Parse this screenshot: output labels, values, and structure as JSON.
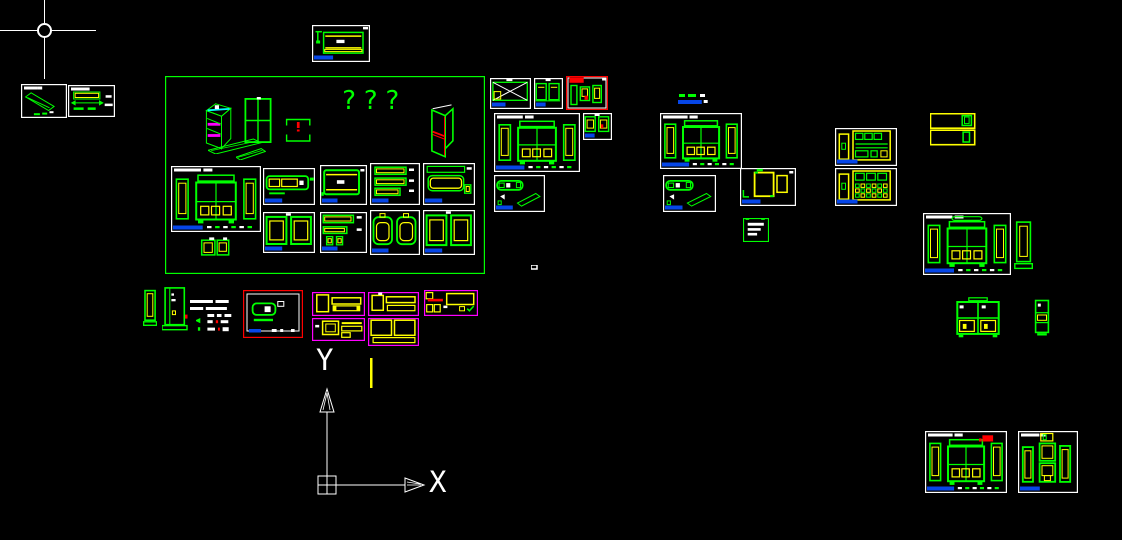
{
  "app": {
    "view": "cad-model-space",
    "background": "#000000"
  },
  "palette": {
    "green": "#00ff00",
    "yellow": "#ffff00",
    "red": "#ff0000",
    "magenta": "#ff00ff",
    "cyan": "#00ffff",
    "blue": "#0646e8",
    "white": "#ffffff",
    "background": "#000000"
  },
  "cursor": {
    "x": 44,
    "y": 30,
    "h_len": 96,
    "v_len": 79
  },
  "ucs_icon": {
    "x_label": "X",
    "y_label": "Y"
  },
  "texts": {
    "question_marks": "???"
  },
  "items": [
    {
      "id": "sheet-iso-plank",
      "kind": "iso_plank",
      "x": 21,
      "y": 84,
      "w": 46,
      "h": 34,
      "border": "white",
      "tt": true
    },
    {
      "id": "sheet-bar-section",
      "kind": "bar_section",
      "x": 68,
      "y": 85,
      "w": 47,
      "h": 32,
      "border": "white",
      "tt": true
    },
    {
      "id": "sheet-top-center",
      "kind": "sheet_cabinet",
      "x": 312,
      "y": 25,
      "w": 58,
      "h": 37,
      "border": "white",
      "tb": true
    },
    {
      "id": "green-boundary-rect",
      "kind": "empty",
      "x": 165,
      "y": 76,
      "w": 320,
      "h": 198,
      "border": "green"
    },
    {
      "id": "iso-cabinet-drawing",
      "kind": "iso_cabinet",
      "x": 198,
      "y": 96,
      "w": 42,
      "h": 56
    },
    {
      "id": "plank-strip-1",
      "kind": "strip",
      "x": 208,
      "y": 137,
      "w": 54,
      "h": 17
    },
    {
      "id": "plank-strip-2",
      "kind": "strip",
      "x": 236,
      "y": 147,
      "w": 30,
      "h": 13
    },
    {
      "id": "four-pane-panel",
      "kind": "panes4",
      "x": 243,
      "y": 97,
      "w": 30,
      "h": 48
    },
    {
      "id": "bracket-detail",
      "kind": "brackets_excl",
      "x": 285,
      "y": 118,
      "w": 27,
      "h": 25
    },
    {
      "id": "iso-door-drawing",
      "kind": "iso_door",
      "x": 427,
      "y": 102,
      "w": 35,
      "h": 57
    },
    {
      "id": "sheet-wardrobe-elev-1",
      "kind": "cab_flanked",
      "x": 171,
      "y": 166,
      "w": 90,
      "h": 66,
      "border": "white",
      "tb": true,
      "tt": true,
      "dash": true
    },
    {
      "id": "mini-cabinet-detail",
      "kind": "mini_cab",
      "x": 200,
      "y": 237,
      "w": 33,
      "h": 21
    },
    {
      "id": "sheet-long-front",
      "kind": "long_front",
      "x": 263,
      "y": 168,
      "w": 52,
      "h": 37,
      "border": "white",
      "tb": true
    },
    {
      "id": "sheet-two-frames-1",
      "kind": "two_frames",
      "x": 263,
      "y": 212,
      "w": 52,
      "h": 41,
      "border": "white",
      "tb": true
    },
    {
      "id": "sheet-board",
      "kind": "board_rect",
      "x": 320,
      "y": 165,
      "w": 47,
      "h": 40,
      "border": "white",
      "tb": true
    },
    {
      "id": "sheet-bars",
      "kind": "bars3",
      "x": 370,
      "y": 163,
      "w": 50,
      "h": 42,
      "border": "white",
      "tb": true
    },
    {
      "id": "sheet-rounded-top",
      "kind": "rect_round",
      "x": 423,
      "y": 163,
      "w": 52,
      "h": 42,
      "border": "white",
      "tb": true
    },
    {
      "id": "sheet-bars-cups",
      "kind": "bars_cups",
      "x": 320,
      "y": 212,
      "w": 47,
      "h": 41,
      "border": "white",
      "tb": true
    },
    {
      "id": "sheet-rounded-pair",
      "kind": "rounded_pair",
      "x": 370,
      "y": 210,
      "w": 50,
      "h": 45,
      "border": "white",
      "tb": true
    },
    {
      "id": "sheet-two-frames-2",
      "kind": "two_frames",
      "x": 423,
      "y": 210,
      "w": 52,
      "h": 45,
      "border": "white",
      "tb": true
    },
    {
      "id": "sheet-crossed-box",
      "kind": "crossed_box",
      "x": 490,
      "y": 78,
      "w": 41,
      "h": 31,
      "border": "white",
      "tb": true
    },
    {
      "id": "sheet-mini-cabs",
      "kind": "mini_cab2",
      "x": 534,
      "y": 78,
      "w": 29,
      "h": 31,
      "border": "white",
      "tb": true
    },
    {
      "id": "sheet-red-flag",
      "kind": "red_flag_cab",
      "x": 566,
      "y": 76,
      "w": 42,
      "h": 34,
      "border": "red"
    },
    {
      "id": "sheet-wardrobe-elev-2",
      "kind": "cab_flanked",
      "x": 494,
      "y": 113,
      "w": 86,
      "h": 59,
      "border": "white",
      "tb": true,
      "tt": true,
      "dash": true
    },
    {
      "id": "sheet-mini-frames",
      "kind": "mini_frames",
      "x": 583,
      "y": 113,
      "w": 29,
      "h": 27,
      "border": "white",
      "tb": true
    },
    {
      "id": "sheet-hardware-1",
      "kind": "iso_bar_plank",
      "x": 494,
      "y": 175,
      "w": 51,
      "h": 37,
      "border": "white",
      "tb": true
    },
    {
      "id": "stray-speck",
      "kind": "speck",
      "x": 531,
      "y": 265,
      "w": 7,
      "h": 5
    },
    {
      "id": "mini-title-block",
      "kind": "mini_title",
      "x": 678,
      "y": 94,
      "w": 33,
      "h": 10
    },
    {
      "id": "sheet-wardrobe-elev-3",
      "kind": "cab_flanked",
      "x": 660,
      "y": 113,
      "w": 82,
      "h": 56,
      "border": "white",
      "tb": true,
      "tt": true,
      "dash": true
    },
    {
      "id": "sheet-hardware-2",
      "kind": "iso_bar_plank",
      "x": 663,
      "y": 175,
      "w": 53,
      "h": 37,
      "border": "white",
      "tb": true
    },
    {
      "id": "sheet-plan-view",
      "kind": "plan_boxes",
      "x": 740,
      "y": 168,
      "w": 56,
      "h": 38,
      "border": "white",
      "tb": true
    },
    {
      "id": "stamp-block",
      "kind": "stamp",
      "x": 743,
      "y": 218,
      "w": 26,
      "h": 24
    },
    {
      "id": "sheet-yellow-cab-1",
      "kind": "yellow_cabinet",
      "x": 835,
      "y": 128,
      "w": 62,
      "h": 38,
      "border": "white",
      "tb": true
    },
    {
      "id": "sheet-yellow-cab-2",
      "kind": "yellow_cabinet_grid",
      "x": 835,
      "y": 168,
      "w": 62,
      "h": 38,
      "border": "white",
      "tb": true
    },
    {
      "id": "yellow-boxes",
      "kind": "yellow_boxes2",
      "x": 930,
      "y": 113,
      "w": 46,
      "h": 33
    },
    {
      "id": "sheet-wardrobe-elev-4",
      "kind": "cab_flanked",
      "x": 923,
      "y": 213,
      "w": 88,
      "h": 62,
      "border": "white",
      "tb": true,
      "tt": true,
      "dash": true,
      "cap": true
    },
    {
      "id": "tower-detail-1",
      "kind": "tower",
      "x": 1014,
      "y": 220,
      "w": 19,
      "h": 52
    },
    {
      "id": "green-cabinet-front",
      "kind": "green_cab_front",
      "x": 955,
      "y": 297,
      "w": 46,
      "h": 42
    },
    {
      "id": "green-cabinet-narrow",
      "kind": "green_cab_narrow",
      "x": 1034,
      "y": 299,
      "w": 16,
      "h": 38
    },
    {
      "id": "tower-detail-2",
      "kind": "tower",
      "x": 143,
      "y": 289,
      "w": 14,
      "h": 39
    },
    {
      "id": "door-elevation",
      "kind": "door_small",
      "x": 162,
      "y": 287,
      "w": 26,
      "h": 46
    },
    {
      "id": "annotation-text",
      "kind": "anno_text",
      "x": 190,
      "y": 300,
      "w": 44,
      "h": 12
    },
    {
      "id": "annotation-marks",
      "kind": "anno_marks",
      "x": 196,
      "y": 314,
      "w": 38,
      "h": 22
    },
    {
      "id": "sheet-red-border",
      "kind": "red_iso",
      "x": 243,
      "y": 290,
      "w": 60,
      "h": 48,
      "border": "red"
    },
    {
      "id": "sheet-mag-1",
      "kind": "mag_a",
      "x": 312,
      "y": 292,
      "w": 53,
      "h": 24,
      "border": "magenta"
    },
    {
      "id": "sheet-mag-2",
      "kind": "mag_b",
      "x": 368,
      "y": 292,
      "w": 51,
      "h": 24,
      "border": "magenta"
    },
    {
      "id": "sheet-mag-3",
      "kind": "mag_c",
      "x": 424,
      "y": 290,
      "w": 54,
      "h": 26,
      "border": "magenta"
    },
    {
      "id": "sheet-mag-4",
      "kind": "mag_d",
      "x": 312,
      "y": 318,
      "w": 53,
      "h": 23,
      "border": "magenta"
    },
    {
      "id": "sheet-mag-5",
      "kind": "mag_e",
      "x": 368,
      "y": 318,
      "w": 51,
      "h": 28,
      "border": "magenta"
    },
    {
      "id": "yellow-tick-line",
      "kind": "vline_yellow",
      "x": 370,
      "y": 358,
      "w": 3,
      "h": 30
    },
    {
      "id": "sheet-wardrobe-elev-5",
      "kind": "cab_flanked",
      "x": 925,
      "y": 431,
      "w": 82,
      "h": 62,
      "border": "white",
      "tb": true,
      "tt": true,
      "dash": true,
      "red_accent": true
    },
    {
      "id": "sheet-tall-cabinets",
      "kind": "tall_cabs",
      "x": 1018,
      "y": 431,
      "w": 60,
      "h": 62,
      "border": "white",
      "tb": true,
      "tt": true
    }
  ]
}
